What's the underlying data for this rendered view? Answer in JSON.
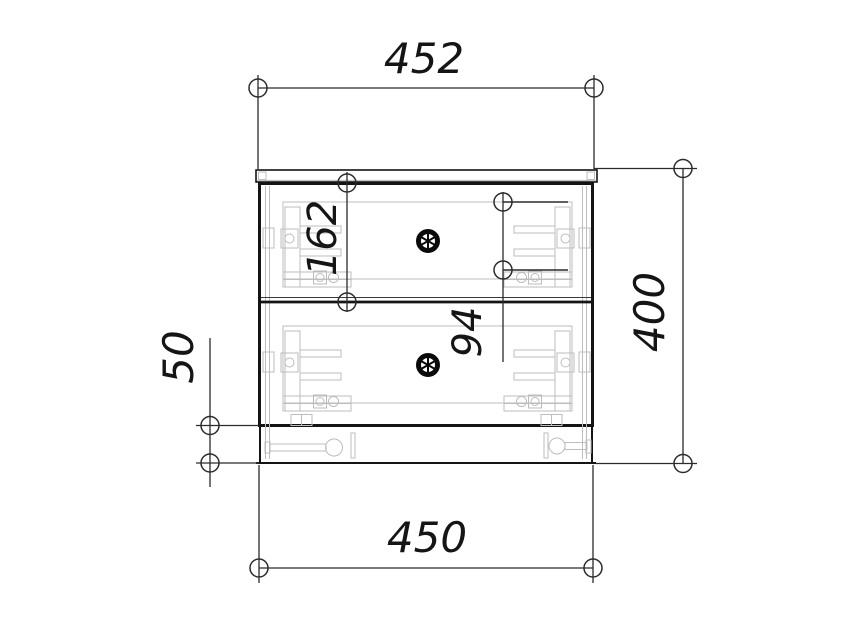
{
  "drawing": {
    "kind": "technical-drawing",
    "view": "cabinet-front-elevation",
    "labels": {
      "top_width": "452",
      "overall_height": "400",
      "bottom_width": "450",
      "plinth_height": "50",
      "top_drawer_height": "162",
      "drawer_side_height": "94"
    },
    "icons": {
      "knob": "wheel-knob-icon",
      "dimension_end": "circle-end-marker"
    },
    "colors": {
      "line": "#141414",
      "dimension": "#2b2b2b",
      "hardware": "#bdbdbd",
      "background": "#ffffff"
    }
  }
}
